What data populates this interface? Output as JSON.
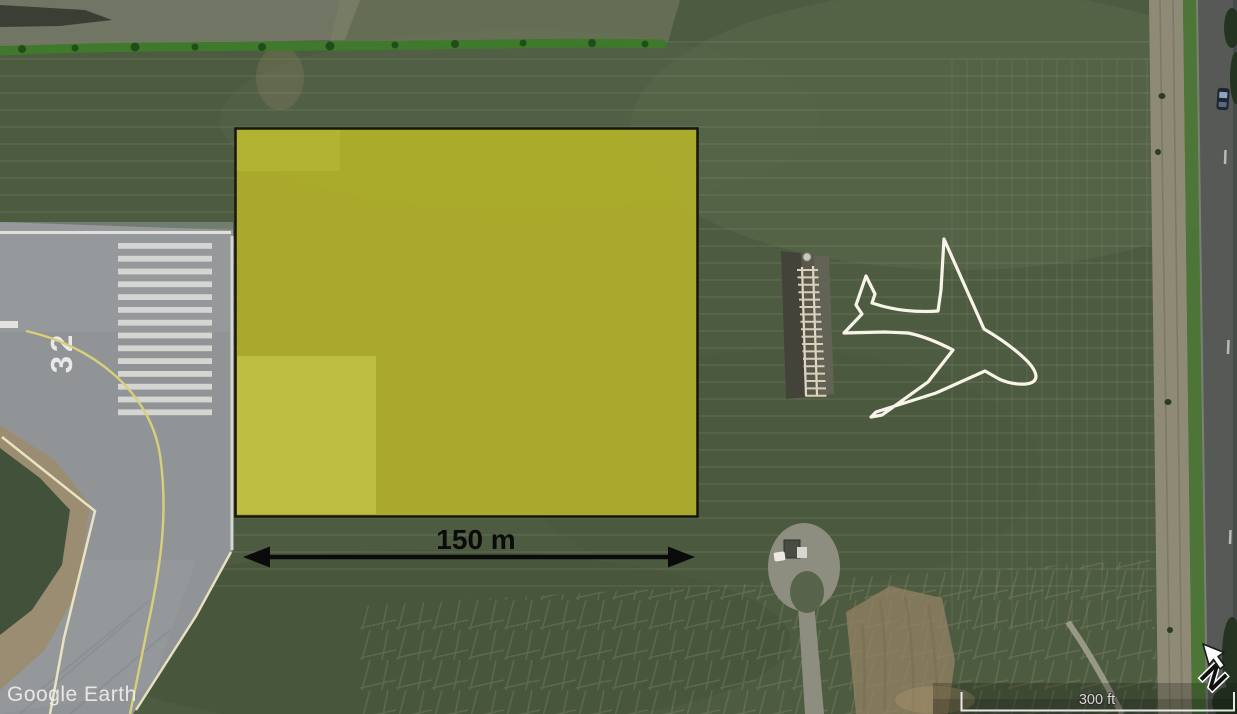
{
  "watermark": {
    "label": "Google Earth"
  },
  "scale_bar": {
    "label": "300 ft"
  },
  "compass": {
    "north_label": "N"
  },
  "runway": {
    "designator": "32"
  },
  "measurement": {
    "label": "150 m",
    "color": "#0b0b0b"
  },
  "overlay": {
    "fill_color": "#aead2b",
    "border_color": "#161612"
  },
  "ground_marking": {
    "shape": "airplane-outline",
    "color": "#f8f4ea"
  }
}
